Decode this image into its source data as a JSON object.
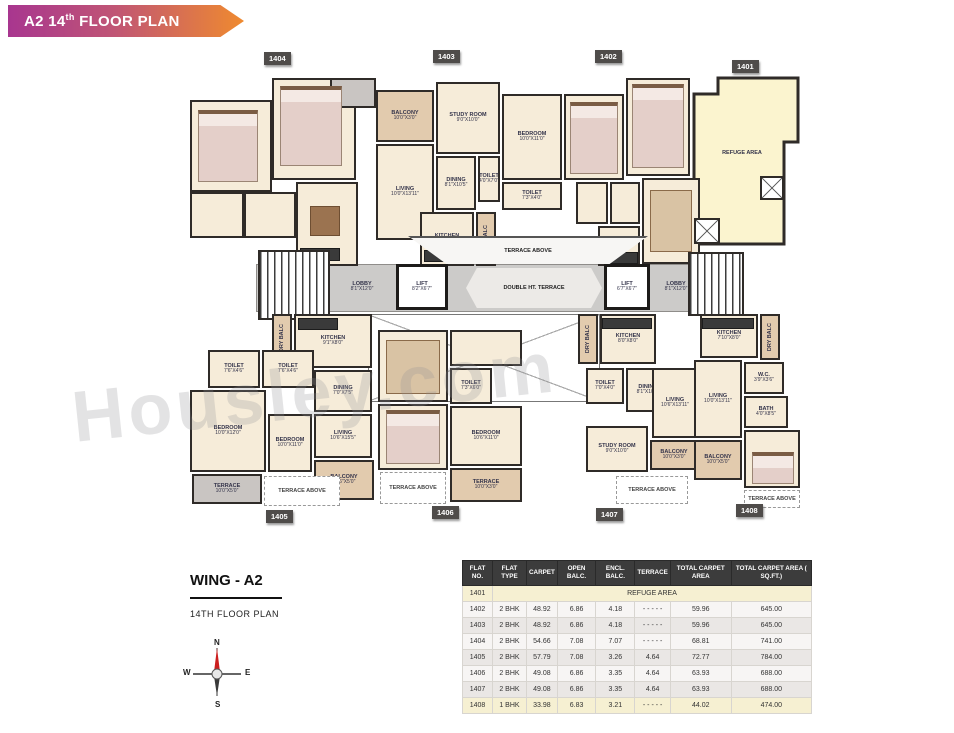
{
  "banner": {
    "title_prefix": "A2 14",
    "title_sup": "th",
    "title_suffix": " FLOOR PLAN"
  },
  "watermark": "Housley.com",
  "wing": {
    "title": "WING - A2",
    "subtitle": "14TH FLOOR PLAN"
  },
  "compass": {
    "n": "N",
    "e": "E",
    "s": "S",
    "w": "W"
  },
  "colors": {
    "banner_left": "#a8368f",
    "banner_right": "#ef8a2f",
    "room_cream": "#f6ecd9",
    "balcony_tan": "#e2cbae",
    "refuge_yellow": "#fbf4cf",
    "corridor_gray": "#cccbc9",
    "wall_dark": "#2f2b28",
    "badge_gray": "#4f4c4a",
    "north_red": "#cc1f1f"
  },
  "plan": {
    "refuge_label": "REFUGE AREA",
    "badges": [
      {
        "label": "1404",
        "x": 264,
        "y": 52
      },
      {
        "label": "1403",
        "x": 433,
        "y": 50
      },
      {
        "label": "1402",
        "x": 595,
        "y": 50
      },
      {
        "label": "1401",
        "x": 732,
        "y": 60
      },
      {
        "label": "1405",
        "x": 266,
        "y": 510
      },
      {
        "label": "1406",
        "x": 432,
        "y": 506
      },
      {
        "label": "1407",
        "x": 596,
        "y": 508
      },
      {
        "label": "1408",
        "x": 736,
        "y": 504
      }
    ],
    "elements": [
      {
        "kind": "corridor",
        "n": "corridor",
        "x": 256,
        "y": 264,
        "w": 446,
        "h": 48
      },
      {
        "kind": "xvoid",
        "n": "double-height-void",
        "x": 368,
        "y": 314,
        "w": 232,
        "h": 88
      },
      {
        "kind": "room",
        "n": "u1404-bedroom-1",
        "x": 190,
        "y": 100,
        "w": 82,
        "h": 92
      },
      {
        "kind": "room",
        "n": "u1404-bedroom-2",
        "x": 272,
        "y": 78,
        "w": 84,
        "h": 102
      },
      {
        "kind": "gray",
        "n": "u1404-sitout",
        "x": 330,
        "y": 78,
        "w": 46,
        "h": 30
      },
      {
        "kind": "room",
        "n": "u1404-toilet-1",
        "x": 190,
        "y": 192,
        "w": 54,
        "h": 46
      },
      {
        "kind": "room",
        "n": "u1404-toilet-2",
        "x": 244,
        "y": 192,
        "w": 52,
        "h": 46
      },
      {
        "kind": "room",
        "n": "u1404-hall",
        "x": 296,
        "y": 182,
        "w": 62,
        "h": 84
      },
      {
        "kind": "bed",
        "n": "bed",
        "x": 198,
        "y": 110,
        "w": 60,
        "h": 72
      },
      {
        "kind": "bed",
        "n": "bed",
        "x": 280,
        "y": 86,
        "w": 62,
        "h": 80
      },
      {
        "kind": "tablef",
        "n": "dining-table",
        "x": 310,
        "y": 206,
        "w": 30,
        "h": 30
      },
      {
        "kind": "counter",
        "n": "kitchen-counter",
        "x": 300,
        "y": 248,
        "w": 40,
        "h": 13
      },
      {
        "kind": "balcony",
        "n": "u1403-balcony",
        "x": 376,
        "y": 90,
        "w": 58,
        "h": 52,
        "label": "BALCONY",
        "dims": "10'0\"X3'0\""
      },
      {
        "kind": "room",
        "n": "u1403-study",
        "x": 436,
        "y": 82,
        "w": 64,
        "h": 72,
        "label": "STUDY ROOM",
        "dims": "9'0\"X10'0\""
      },
      {
        "kind": "room",
        "n": "u1403-bedroom",
        "x": 502,
        "y": 94,
        "w": 60,
        "h": 86,
        "label": "BEDROOM",
        "dims": "10'0\"X11'0\""
      },
      {
        "kind": "room",
        "n": "u1403-living",
        "x": 376,
        "y": 144,
        "w": 58,
        "h": 96,
        "label": "LIVING",
        "dims": "10'0\"X13'11\""
      },
      {
        "kind": "room",
        "n": "u1403-dining",
        "x": 436,
        "y": 156,
        "w": 40,
        "h": 54,
        "label": "DINING",
        "dims": "8'1\"X10'5\""
      },
      {
        "kind": "room",
        "n": "u1403-toilet-1",
        "x": 478,
        "y": 156,
        "w": 22,
        "h": 46,
        "label": "TOILET",
        "dims": "4'0\"X7'0\""
      },
      {
        "kind": "room",
        "n": "u1403-toilet-2",
        "x": 502,
        "y": 182,
        "w": 60,
        "h": 28,
        "label": "TOILET",
        "dims": "7'3\"X4'0\""
      },
      {
        "kind": "room",
        "n": "u1403-kitchen",
        "x": 420,
        "y": 212,
        "w": 54,
        "h": 54,
        "label": "KITCHEN",
        "dims": "8'0\"X8'0\""
      },
      {
        "kind": "counter",
        "n": "kitchen-counter",
        "x": 424,
        "y": 250,
        "w": 44,
        "h": 12
      },
      {
        "kind": "balcony",
        "n": "u1403-dry-balcony",
        "x": 476,
        "y": 212,
        "w": 20,
        "h": 54,
        "label": "DRY BALC",
        "vertical": true
      },
      {
        "kind": "room",
        "n": "u1402-bedroom-1",
        "x": 564,
        "y": 94,
        "w": 60,
        "h": 86
      },
      {
        "kind": "room",
        "n": "u1402-bedroom-2",
        "x": 626,
        "y": 78,
        "w": 64,
        "h": 98
      },
      {
        "kind": "bed",
        "n": "bed",
        "x": 570,
        "y": 102,
        "w": 48,
        "h": 72
      },
      {
        "kind": "bed",
        "n": "bed",
        "x": 632,
        "y": 84,
        "w": 52,
        "h": 84
      },
      {
        "kind": "room",
        "n": "u1402-toilet-1",
        "x": 576,
        "y": 182,
        "w": 32,
        "h": 42
      },
      {
        "kind": "room",
        "n": "u1402-toilet-2",
        "x": 610,
        "y": 182,
        "w": 30,
        "h": 42
      },
      {
        "kind": "room",
        "n": "u1402-living",
        "x": 642,
        "y": 178,
        "w": 58,
        "h": 86
      },
      {
        "kind": "sofa",
        "n": "sofa",
        "x": 650,
        "y": 190,
        "w": 42,
        "h": 62
      },
      {
        "kind": "room",
        "n": "u1402-kitchen",
        "x": 598,
        "y": 226,
        "w": 42,
        "h": 40
      },
      {
        "kind": "counter",
        "n": "kitchen-counter",
        "x": 600,
        "y": 252,
        "w": 38,
        "h": 12
      },
      {
        "kind": "label",
        "n": "refuge-area-label",
        "x": 700,
        "y": 146,
        "w": 84,
        "h": 14,
        "label": "REFUGE AREA"
      },
      {
        "kind": "xbox",
        "n": "shaft",
        "x": 760,
        "y": 176,
        "w": 24,
        "h": 24
      },
      {
        "kind": "xbox",
        "n": "shaft",
        "x": 694,
        "y": 218,
        "w": 26,
        "h": 26
      },
      {
        "kind": "stairs",
        "n": "staircase-left",
        "x": 258,
        "y": 250,
        "w": 72,
        "h": 70
      },
      {
        "kind": "label",
        "n": "lobby-left",
        "x": 332,
        "y": 270,
        "w": 60,
        "h": 34,
        "label": "LOBBY",
        "dims": "8'1\"X12'0\""
      },
      {
        "kind": "lift",
        "n": "lift-left",
        "x": 396,
        "y": 264,
        "w": 52,
        "h": 46,
        "label": "LIFT",
        "dims": "8'2\"X6'7\""
      },
      {
        "kind": "trapA",
        "n": "terrace-above-center",
        "x": 408,
        "y": 236,
        "w": 240,
        "h": 28,
        "label": "TERRACE ABOVE"
      },
      {
        "kind": "trapB",
        "n": "double-ht-terrace",
        "x": 466,
        "y": 268,
        "w": 136,
        "h": 40,
        "label": "DOUBLE HT. TERRACE"
      },
      {
        "kind": "lift",
        "n": "lift-right",
        "x": 604,
        "y": 264,
        "w": 46,
        "h": 46,
        "label": "LIFT",
        "dims": "6'7\"X6'7\""
      },
      {
        "kind": "label",
        "n": "lobby-right",
        "x": 652,
        "y": 270,
        "w": 48,
        "h": 34,
        "label": "LOBBY",
        "dims": "8'1\"X12'0\""
      },
      {
        "kind": "stairs",
        "n": "staircase-right",
        "x": 688,
        "y": 252,
        "w": 56,
        "h": 64
      },
      {
        "kind": "balcony",
        "n": "u1405-dry-balcony",
        "x": 272,
        "y": 314,
        "w": 20,
        "h": 48,
        "label": "DRY BALC",
        "vertical": true
      },
      {
        "kind": "room",
        "n": "u1405-kitchen",
        "x": 294,
        "y": 314,
        "w": 78,
        "h": 54,
        "label": "KITCHEN",
        "dims": "9'1\"X8'0\""
      },
      {
        "kind": "counter",
        "n": "kitchen-counter",
        "x": 298,
        "y": 318,
        "w": 40,
        "h": 12
      },
      {
        "kind": "room",
        "n": "u1405-toilet-1",
        "x": 208,
        "y": 350,
        "w": 52,
        "h": 38,
        "label": "TOILET",
        "dims": "7'6\"X4'6\""
      },
      {
        "kind": "room",
        "n": "u1405-toilet-2",
        "x": 262,
        "y": 350,
        "w": 52,
        "h": 38,
        "label": "TOILET",
        "dims": "7'6\"X4'6\""
      },
      {
        "kind": "room",
        "n": "u1405-dining",
        "x": 314,
        "y": 370,
        "w": 58,
        "h": 42,
        "label": "DINING",
        "dims": "7'0\"X7'5\""
      },
      {
        "kind": "room",
        "n": "u1405-living",
        "x": 314,
        "y": 414,
        "w": 58,
        "h": 44,
        "label": "LIVING",
        "dims": "10'6\"X15'5\""
      },
      {
        "kind": "room",
        "n": "u1405-bedroom-1",
        "x": 190,
        "y": 390,
        "w": 76,
        "h": 82,
        "label": "BEDROOM",
        "dims": "10'0\"X12'0\""
      },
      {
        "kind": "room",
        "n": "u1405-bedroom-2",
        "x": 268,
        "y": 414,
        "w": 44,
        "h": 58,
        "label": "BEDROOM",
        "dims": "10'0\"X11'0\""
      },
      {
        "kind": "balcony",
        "n": "u1405-balcony",
        "x": 314,
        "y": 460,
        "w": 60,
        "h": 40,
        "label": "BALCONY",
        "dims": "10'6\"X5'0\""
      },
      {
        "kind": "gray",
        "n": "u1405-terrace",
        "x": 192,
        "y": 474,
        "w": 70,
        "h": 30,
        "label": "TERRACE",
        "dims": "10'0\"X5'0\""
      },
      {
        "kind": "dashed",
        "n": "u1405-terrace-above",
        "x": 264,
        "y": 476,
        "w": 76,
        "h": 30,
        "label": "TERRACE ABOVE"
      },
      {
        "kind": "room",
        "n": "u1406-living",
        "x": 378,
        "y": 330,
        "w": 70,
        "h": 72
      },
      {
        "kind": "sofa",
        "n": "sofa",
        "x": 386,
        "y": 340,
        "w": 54,
        "h": 54
      },
      {
        "kind": "room",
        "n": "u1406-hall",
        "x": 450,
        "y": 330,
        "w": 72,
        "h": 36
      },
      {
        "kind": "room",
        "n": "u1406-toilet",
        "x": 450,
        "y": 368,
        "w": 42,
        "h": 36,
        "label": "TOILET",
        "dims": "7'3\"X6'0\""
      },
      {
        "kind": "room",
        "n": "u1406-bedroom-1",
        "x": 378,
        "y": 404,
        "w": 70,
        "h": 66
      },
      {
        "kind": "bed",
        "n": "bed",
        "x": 386,
        "y": 410,
        "w": 54,
        "h": 54
      },
      {
        "kind": "room",
        "n": "u1406-bedroom-2",
        "x": 450,
        "y": 406,
        "w": 72,
        "h": 60,
        "label": "BEDROOM",
        "dims": "10'6\"X11'0\""
      },
      {
        "kind": "balcony",
        "n": "u1406-terrace",
        "x": 450,
        "y": 468,
        "w": 72,
        "h": 34,
        "label": "TERRACE",
        "dims": "10'0\"X3'0\""
      },
      {
        "kind": "dashed",
        "n": "u1406-terrace-above",
        "x": 380,
        "y": 472,
        "w": 66,
        "h": 32,
        "label": "TERRACE ABOVE"
      },
      {
        "kind": "balcony",
        "n": "u1407-dry-balcony",
        "x": 578,
        "y": 314,
        "w": 20,
        "h": 50,
        "label": "DRY BALC",
        "vertical": true
      },
      {
        "kind": "room",
        "n": "u1407-kitchen",
        "x": 600,
        "y": 314,
        "w": 56,
        "h": 50,
        "label": "KITCHEN",
        "dims": "8'0\"X8'0\""
      },
      {
        "kind": "counter",
        "n": "kitchen-counter",
        "x": 602,
        "y": 318,
        "w": 50,
        "h": 11
      },
      {
        "kind": "room",
        "n": "u1407-toilet",
        "x": 586,
        "y": 368,
        "w": 38,
        "h": 36,
        "label": "TOILET",
        "dims": "7'0\"X4'0\""
      },
      {
        "kind": "room",
        "n": "u1407-dining",
        "x": 626,
        "y": 368,
        "w": 44,
        "h": 44,
        "label": "DINING",
        "dims": "8'1\"X10'5\""
      },
      {
        "kind": "room",
        "n": "u1407-living",
        "x": 652,
        "y": 368,
        "w": 46,
        "h": 70,
        "label": "LIVING",
        "dims": "10'6\"X13'11\""
      },
      {
        "kind": "room",
        "n": "u1407-study",
        "x": 586,
        "y": 426,
        "w": 62,
        "h": 46,
        "label": "STUDY ROOM",
        "dims": "9'0\"X10'0\""
      },
      {
        "kind": "balcony",
        "n": "u1407-balcony",
        "x": 650,
        "y": 440,
        "w": 48,
        "h": 30,
        "label": "BALCONY",
        "dims": "10'0\"X3'0\""
      },
      {
        "kind": "dashed",
        "n": "u1407-terrace-above",
        "x": 616,
        "y": 476,
        "w": 72,
        "h": 28,
        "label": "TERRACE ABOVE"
      },
      {
        "kind": "room",
        "n": "u1408-kitchen",
        "x": 700,
        "y": 314,
        "w": 58,
        "h": 44,
        "label": "KITCHEN",
        "dims": "7'10\"X8'0\""
      },
      {
        "kind": "counter",
        "n": "kitchen-counter",
        "x": 702,
        "y": 318,
        "w": 52,
        "h": 11
      },
      {
        "kind": "balcony",
        "n": "u1408-dry-balcony",
        "x": 760,
        "y": 314,
        "w": 20,
        "h": 46,
        "label": "DRY BALC",
        "vertical": true
      },
      {
        "kind": "room",
        "n": "u1408-wc",
        "x": 744,
        "y": 362,
        "w": 40,
        "h": 32,
        "label": "W.C.",
        "dims": "3'9\"X3'6\""
      },
      {
        "kind": "room",
        "n": "u1408-living",
        "x": 694,
        "y": 360,
        "w": 48,
        "h": 78,
        "label": "LIVING",
        "dims": "10'0\"X13'11\""
      },
      {
        "kind": "room",
        "n": "u1408-bath",
        "x": 744,
        "y": 396,
        "w": 44,
        "h": 32,
        "label": "BATH",
        "dims": "4'0\"X8'5\""
      },
      {
        "kind": "room",
        "n": "u1408-bedroom",
        "x": 744,
        "y": 430,
        "w": 56,
        "h": 58,
        "label": "BEDROOM",
        "dims": "9'10\"X10'0\""
      },
      {
        "kind": "bed",
        "n": "bed",
        "x": 752,
        "y": 452,
        "w": 42,
        "h": 32
      },
      {
        "kind": "balcony",
        "n": "u1408-balcony",
        "x": 694,
        "y": 440,
        "w": 48,
        "h": 40,
        "label": "BALCONY",
        "dims": "10'0\"X5'0\""
      },
      {
        "kind": "dashed",
        "n": "u1408-terrace-above",
        "x": 744,
        "y": 490,
        "w": 56,
        "h": 18,
        "label": "TERRACE ABOVE"
      }
    ]
  },
  "table": {
    "headers": [
      "FLAT NO.",
      "FLAT TYPE",
      "CARPET",
      "OPEN BALC.",
      "ENCL. BALC.",
      "TERRACE",
      "TOTAL CARPET AREA",
      "TOTAL CARPET AREA ( SQ.FT.)"
    ],
    "refuge_row": {
      "flat": "1401",
      "label": "REFUGE AREA"
    },
    "rows": [
      [
        "1402",
        "2 BHK",
        "48.92",
        "6.86",
        "4.18",
        "- - - - -",
        "59.96",
        "645.00"
      ],
      [
        "1403",
        "2 BHK",
        "48.92",
        "6.86",
        "4.18",
        "- - - - -",
        "59.96",
        "645.00"
      ],
      [
        "1404",
        "2 BHK",
        "54.66",
        "7.08",
        "7.07",
        "- - - - -",
        "68.81",
        "741.00"
      ],
      [
        "1405",
        "2 BHK",
        "57.79",
        "7.08",
        "3.26",
        "4.64",
        "72.77",
        "784.00"
      ],
      [
        "1406",
        "2 BHK",
        "49.08",
        "6.86",
        "3.35",
        "4.64",
        "63.93",
        "688.00"
      ],
      [
        "1407",
        "2 BHK",
        "49.08",
        "6.86",
        "3.35",
        "4.64",
        "63.93",
        "688.00"
      ],
      [
        "1408",
        "1 BHK",
        "33.98",
        "6.83",
        "3.21",
        "- - - - -",
        "44.02",
        "474.00"
      ]
    ]
  }
}
